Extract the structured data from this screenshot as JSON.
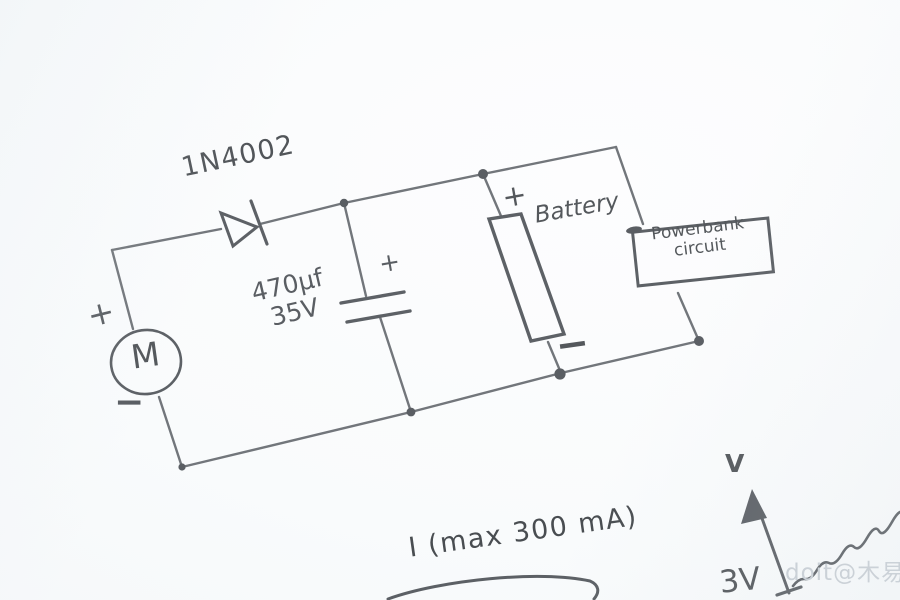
{
  "circuit": {
    "diode_label": "1N4002",
    "capacitor": {
      "value": "470µf",
      "voltage": "35V",
      "polarity_plus": "+"
    },
    "motor": {
      "symbol": "M",
      "polarity_plus": "+",
      "polarity_minus": "−"
    },
    "battery": {
      "label": "Battery",
      "polarity_plus": "+",
      "polarity_minus": "−"
    },
    "powerbank_box": {
      "line1": "Powerbank",
      "line2": "circuit"
    }
  },
  "graph": {
    "current_note": "I (max 300 mA)",
    "y_axis_label": "V",
    "y_axis_tick": "3V"
  },
  "watermark": "doit@木易",
  "colors": {
    "pencil_wire": "#72767b",
    "pencil_dark": "#5d6166",
    "label_text": "#565a5f",
    "paper": "#f8fafc",
    "watermark": "#c9cfd5"
  }
}
